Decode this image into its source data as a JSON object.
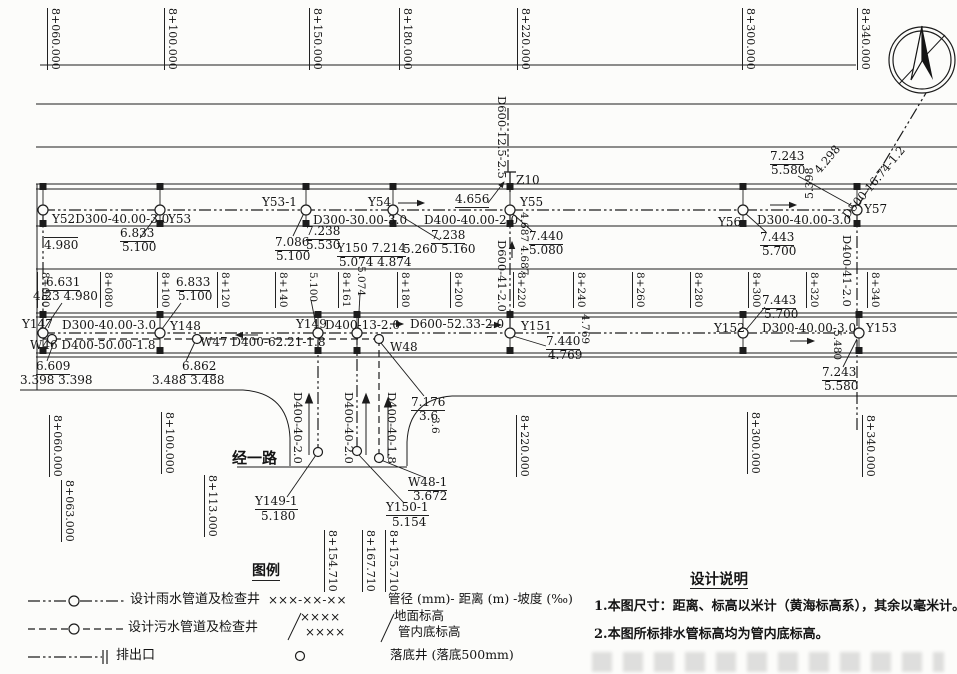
{
  "meta": {
    "drawing_type": "storm-and-sewer-pipeline-plan"
  },
  "stations": {
    "top": [
      {
        "label": "8+060.000",
        "x": 48
      },
      {
        "label": "8+100.000",
        "x": 165
      },
      {
        "label": "8+150.000",
        "x": 310
      },
      {
        "label": "8+180.000",
        "x": 400
      },
      {
        "label": "8+220.000",
        "x": 518
      },
      {
        "label": "8+300.000",
        "x": 743
      },
      {
        "label": "8+340.000",
        "x": 858
      }
    ],
    "mid": [
      {
        "label": "8+060",
        "x": 37
      },
      {
        "label": "8+080",
        "x": 100
      },
      {
        "label": "8+100",
        "x": 157
      },
      {
        "label": "8+120",
        "x": 217
      },
      {
        "label": "8+140",
        "x": 275
      },
      {
        "label": "8+161",
        "x": 338
      },
      {
        "label": "8+180",
        "x": 397
      },
      {
        "label": "8+200",
        "x": 450
      },
      {
        "label": "8+220",
        "x": 513
      },
      {
        "label": "8+240",
        "x": 573
      },
      {
        "label": "8+260",
        "x": 632
      },
      {
        "label": "8+280",
        "x": 690
      },
      {
        "label": "8+300",
        "x": 748
      },
      {
        "label": "8+320",
        "x": 806
      },
      {
        "label": "8+340",
        "x": 867
      }
    ],
    "bottom": [
      {
        "label": "8+060.000",
        "x": 50,
        "y": 415
      },
      {
        "label": "8+063.000",
        "x": 62,
        "y": 480
      },
      {
        "label": "8+100.000",
        "x": 162,
        "y": 412
      },
      {
        "label": "8+113.000",
        "x": 205,
        "y": 475
      },
      {
        "label": "8+154.710",
        "x": 325,
        "y": 530
      },
      {
        "label": "8+167.710",
        "x": 363,
        "y": 530
      },
      {
        "label": "8+175.710",
        "x": 386,
        "y": 530
      },
      {
        "label": "8+220.000",
        "x": 517,
        "y": 415
      },
      {
        "label": "8+300.000",
        "x": 748,
        "y": 412
      },
      {
        "label": "8+340.000",
        "x": 863,
        "y": 415
      }
    ]
  },
  "manholes": {
    "rain_top": [
      {
        "id": "Y52",
        "x": 43
      },
      {
        "id": "Y53",
        "x": 160
      },
      {
        "id": "Y53-1",
        "x": 306
      },
      {
        "id": "Y54",
        "x": 393
      },
      {
        "id": "Y55",
        "x": 510
      },
      {
        "id": "Y56",
        "x": 743
      },
      {
        "id": "Y57",
        "x": 857
      }
    ],
    "rain_bottom": [
      {
        "id": "Y147",
        "x": 43
      },
      {
        "id": "Y148",
        "x": 160
      },
      {
        "id": "Y149",
        "x": 318
      },
      {
        "id": "Y150",
        "x": 357
      },
      {
        "id": "Y151",
        "x": 510
      },
      {
        "id": "Y152",
        "x": 743
      },
      {
        "id": "Y153",
        "x": 859
      }
    ],
    "sewer": [
      {
        "id": "W46",
        "x": 52
      },
      {
        "id": "W47",
        "x": 197
      },
      {
        "id": "W48",
        "x": 379
      }
    ],
    "minor": [
      {
        "id": "Y149-1",
        "x": 318,
        "y": 452
      },
      {
        "id": "Y150-1",
        "x": 357,
        "y": 451
      },
      {
        "id": "W48-1",
        "x": 379,
        "y": 458
      }
    ]
  },
  "labels": [
    {
      "n": "pipe-spec",
      "t": "Y52D300-40.00-3.0",
      "x": 52,
      "y": 213
    },
    {
      "n": "well-label",
      "t": "Y53",
      "x": 168,
      "y": 213
    },
    {
      "n": "well-label",
      "t": "Y53-1",
      "x": 262,
      "y": 196
    },
    {
      "n": "pipe-spec",
      "t": "D300-30.00-3.0",
      "x": 313,
      "y": 214
    },
    {
      "n": "well-label",
      "t": "Y54",
      "x": 368,
      "y": 196
    },
    {
      "n": "elev",
      "t": "4.656",
      "x": 455,
      "y": 193,
      "u": 1
    },
    {
      "n": "well-label",
      "t": "Z10",
      "x": 516,
      "y": 174
    },
    {
      "n": "well-label",
      "t": "Y55",
      "x": 520,
      "y": 196
    },
    {
      "n": "pipe-spec",
      "t": "D400-40.00-2.0",
      "x": 424,
      "y": 214
    },
    {
      "n": "well-label",
      "t": "Y56",
      "x": 718,
      "y": 216
    },
    {
      "n": "pipe-spec",
      "t": "D300-40.00-3.0",
      "x": 757,
      "y": 214
    },
    {
      "n": "well-label",
      "t": "Y57",
      "x": 864,
      "y": 203
    },
    {
      "n": "pipe-spec",
      "t": "D600-12.5-2.5",
      "x": 496,
      "y": 96,
      "r": 90,
      "fs": 11.5
    },
    {
      "n": "elev",
      "t": "7.243",
      "x": 770,
      "y": 150,
      "u": 1
    },
    {
      "n": "elev",
      "t": "5.580",
      "x": 771,
      "y": 164
    },
    {
      "n": "elev",
      "t": "5.398",
      "x": 804,
      "y": 199,
      "r": -90,
      "fs": 11
    },
    {
      "n": "elev",
      "t": "4.298",
      "x": 812,
      "y": 168,
      "diag": 1,
      "fs": 11.5
    },
    {
      "n": "pipe-spec",
      "t": "D500-16.74-1.2",
      "x": 840,
      "y": 213,
      "diag": 1,
      "fs": 11.5
    },
    {
      "n": "elev",
      "t": "7.440",
      "x": 529,
      "y": 230,
      "u": 1
    },
    {
      "n": "elev",
      "t": "5.080",
      "x": 529,
      "y": 244
    },
    {
      "n": "elev",
      "t": "4.687 4.687",
      "x": 517,
      "y": 212,
      "r": 90,
      "fs": 10.5
    },
    {
      "n": "pipe-spec",
      "t": "D600-41-2.0",
      "x": 496,
      "y": 240,
      "r": 90,
      "fs": 11.5
    },
    {
      "n": "elev",
      "t": "4.980",
      "x": 44,
      "y": 237,
      "o": 1
    },
    {
      "n": "elev",
      "t": "6.833",
      "x": 120,
      "y": 227,
      "u": 1
    },
    {
      "n": "elev",
      "t": "5.100",
      "x": 122,
      "y": 241
    },
    {
      "n": "elev",
      "t": "7.086",
      "x": 275,
      "y": 236,
      "u": 1
    },
    {
      "n": "elev",
      "t": "5.100",
      "x": 276,
      "y": 250
    },
    {
      "n": "elev",
      "t": "7.238",
      "x": 306,
      "y": 225,
      "u": 1
    },
    {
      "n": "elev",
      "t": "5.530",
      "x": 306,
      "y": 239
    },
    {
      "n": "elev",
      "t": "Y150 7.214",
      "x": 337,
      "y": 242,
      "u": 1
    },
    {
      "n": "elev",
      "t": "5.074 4.874",
      "x": 339,
      "y": 256
    },
    {
      "n": "elev",
      "t": "7.238",
      "x": 431,
      "y": 229,
      "u": 1
    },
    {
      "n": "elev",
      "t": "5.260 5.160",
      "x": 403,
      "y": 243
    },
    {
      "n": "elev",
      "t": "7.443",
      "x": 760,
      "y": 231,
      "u": 1
    },
    {
      "n": "elev",
      "t": "5.700",
      "x": 762,
      "y": 245
    },
    {
      "n": "elev",
      "t": "6.631",
      "x": 46,
      "y": 276,
      "u": 1
    },
    {
      "n": "elev",
      "t": "4.23 4.980",
      "x": 33,
      "y": 290
    },
    {
      "n": "elev",
      "t": "6.833",
      "x": 176,
      "y": 276,
      "u": 1
    },
    {
      "n": "elev",
      "t": "5.100",
      "x": 178,
      "y": 290
    },
    {
      "n": "elev",
      "t": "5.100",
      "x": 306,
      "y": 272,
      "r": 90,
      "fs": 10.5
    },
    {
      "n": "elev",
      "t": "5.074",
      "x": 354,
      "y": 266,
      "r": 90,
      "fs": 10.5
    },
    {
      "n": "well-label",
      "t": "Y147",
      "x": 22,
      "y": 318
    },
    {
      "n": "pipe-spec",
      "t": "D300-40.00-3.0",
      "x": 62,
      "y": 319
    },
    {
      "n": "well-label",
      "t": "Y148",
      "x": 170,
      "y": 320
    },
    {
      "n": "well-label",
      "t": "Y149",
      "x": 296,
      "y": 318
    },
    {
      "n": "pipe-spec",
      "t": "D400-13-2.0",
      "x": 325,
      "y": 319
    },
    {
      "n": "pipe-spec",
      "t": "D600-52.33-2.0",
      "x": 410,
      "y": 318
    },
    {
      "n": "well-label",
      "t": "Y151",
      "x": 521,
      "y": 320
    },
    {
      "n": "well-label",
      "t": "Y152",
      "x": 714,
      "y": 322
    },
    {
      "n": "pipe-spec",
      "t": "D300-40.00-3.0",
      "x": 762,
      "y": 322
    },
    {
      "n": "well-label",
      "t": "Y153",
      "x": 866,
      "y": 322
    },
    {
      "n": "pipe-spec",
      "t": "W46 D400-50.00-1.8",
      "x": 30,
      "y": 339
    },
    {
      "n": "pipe-spec",
      "t": "W47 D400-62.21-1.8",
      "x": 200,
      "y": 336
    },
    {
      "n": "well-label",
      "t": "W48",
      "x": 390,
      "y": 341
    },
    {
      "n": "elev",
      "t": "7.440",
      "x": 546,
      "y": 335,
      "u": 1
    },
    {
      "n": "elev",
      "t": "4.769",
      "x": 548,
      "y": 349
    },
    {
      "n": "elev",
      "t": "4.769",
      "x": 578,
      "y": 314,
      "r": 90,
      "fs": 10.5
    },
    {
      "n": "elev",
      "t": "7.443",
      "x": 762,
      "y": 294,
      "u": 1
    },
    {
      "n": "elev",
      "t": "5.700",
      "x": 764,
      "y": 308
    },
    {
      "n": "elev",
      "t": "5.480",
      "x": 830,
      "y": 330,
      "r": 90,
      "fs": 10.5
    },
    {
      "n": "elev",
      "t": "7.243",
      "x": 822,
      "y": 366,
      "u": 1
    },
    {
      "n": "elev",
      "t": "5.580",
      "x": 824,
      "y": 380
    },
    {
      "n": "pipe-spec",
      "t": "D400-41-2.0",
      "x": 841,
      "y": 235,
      "r": 90,
      "fs": 11.5
    },
    {
      "n": "elev",
      "t": "6.609",
      "x": 36,
      "y": 360,
      "u": 1
    },
    {
      "n": "elev",
      "t": "3.398 3.398",
      "x": 20,
      "y": 374
    },
    {
      "n": "elev",
      "t": "6.862",
      "x": 182,
      "y": 360,
      "u": 1
    },
    {
      "n": "elev",
      "t": "3.488 3.488",
      "x": 152,
      "y": 374
    },
    {
      "n": "pipe-spec",
      "t": "D400-40-2.0",
      "x": 292,
      "y": 392,
      "r": 90,
      "fs": 11.5
    },
    {
      "n": "pipe-spec",
      "t": "D400-40-2.0",
      "x": 343,
      "y": 392,
      "r": 90,
      "fs": 11.5
    },
    {
      "n": "pipe-spec",
      "t": "D400-40-1.8",
      "x": 386,
      "y": 392,
      "r": 90,
      "fs": 11.5
    },
    {
      "n": "road-name",
      "t": "经一路",
      "x": 232,
      "y": 451,
      "fs": 15,
      "b": 1
    },
    {
      "n": "elev",
      "t": "7.176",
      "x": 411,
      "y": 396,
      "u": 1
    },
    {
      "n": "elev",
      "t": "3.6",
      "x": 419,
      "y": 410
    },
    {
      "n": "elev",
      "t": "3.6",
      "x": 428,
      "y": 417,
      "r": 90,
      "fs": 10.5
    },
    {
      "n": "well-label",
      "t": "Y149-1",
      "x": 255,
      "y": 495,
      "u": 1
    },
    {
      "n": "elev",
      "t": "5.180",
      "x": 261,
      "y": 510
    },
    {
      "n": "well-label",
      "t": "Y150-1",
      "x": 386,
      "y": 501,
      "u": 1
    },
    {
      "n": "elev",
      "t": "5.154",
      "x": 392,
      "y": 516
    },
    {
      "n": "well-label",
      "t": "W48-1",
      "x": 408,
      "y": 476,
      "u": 1
    },
    {
      "n": "elev",
      "t": "3.672",
      "x": 413,
      "y": 490
    },
    {
      "n": "legend-title",
      "t": "图例",
      "x": 252,
      "y": 564,
      "fs": 14,
      "b": 1,
      "u": 1
    },
    {
      "n": "legend-rain-label",
      "t": "设计雨水管道及检查井",
      "x": 130,
      "y": 593,
      "fs": 13
    },
    {
      "n": "legend-code-pattern",
      "t": "×××-××-××",
      "x": 268,
      "y": 594
    },
    {
      "n": "legend-code-meaning",
      "t": "管径 (mm)- 距离 (m) -坡度 (‰)",
      "x": 388,
      "y": 592,
      "fs": 12.5
    },
    {
      "n": "legend-sewer-label",
      "t": "设计污水管道及检查井",
      "x": 128,
      "y": 621,
      "fs": 13
    },
    {
      "n": "legend-frac-top",
      "t": "××××",
      "x": 300,
      "y": 611
    },
    {
      "n": "legend-frac-bottom",
      "t": "××××",
      "x": 305,
      "y": 626
    },
    {
      "n": "legend-frac-meaning-top",
      "t": "地面标高",
      "x": 394,
      "y": 609,
      "fs": 12.5
    },
    {
      "n": "legend-frac-meaning-bottom",
      "t": "管内底标高",
      "x": 398,
      "y": 625,
      "fs": 12.5
    },
    {
      "n": "legend-outlet-label",
      "t": "排出口",
      "x": 116,
      "y": 649,
      "fs": 13
    },
    {
      "n": "legend-drop-well-label",
      "t": "落底井 (落底500mm)",
      "x": 390,
      "y": 648,
      "fs": 12.5
    },
    {
      "n": "notes-title",
      "t": "设计说明",
      "x": 690,
      "y": 572,
      "fs": 14.5,
      "b": 1,
      "u": 1
    },
    {
      "n": "note-1",
      "t": "1.本图尺寸：距离、标高以米计（黄海标高系），其余以毫米计。",
      "x": 594,
      "y": 600,
      "fs": 13,
      "b": 1
    },
    {
      "n": "note-2",
      "t": "2.本图所标排水管标高均为管内底标高。",
      "x": 594,
      "y": 628,
      "fs": 13,
      "b": 1
    }
  ],
  "colors": {
    "line": "#1c1c1c",
    "text": "#141414",
    "paper": "#fcfcfa"
  }
}
